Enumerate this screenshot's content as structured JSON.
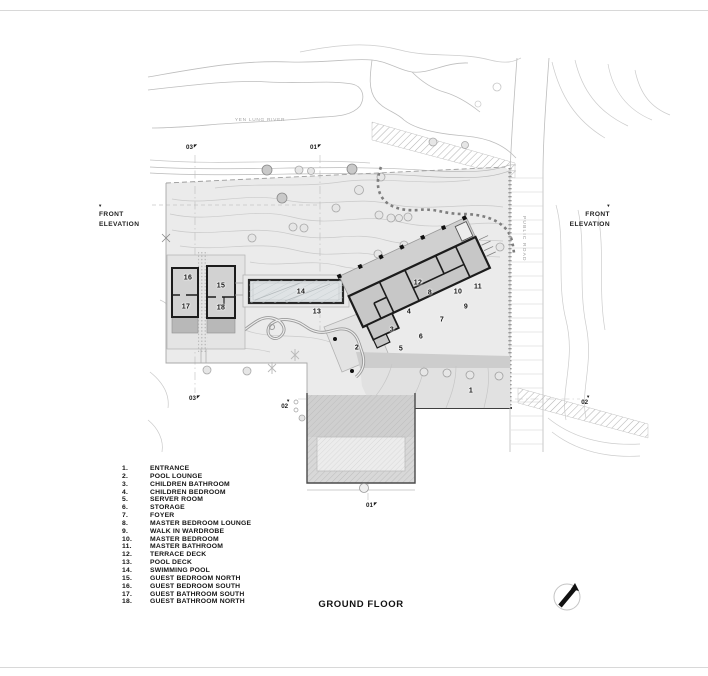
{
  "title": "GROUND FLOOR",
  "annotations": {
    "river_label": "YEN LUNG RIVER",
    "road_label": "PUBLIC ROAD",
    "elevation_left": "FRONT ELEVATION",
    "elevation_right": "FRONT ELEVATION"
  },
  "section_markers": [
    {
      "id": "03",
      "arrow": "nw",
      "x": 186,
      "y": 143
    },
    {
      "id": "01",
      "arrow": "nw",
      "x": 310,
      "y": 143
    },
    {
      "id": "03",
      "arrow": "nw",
      "x": 189,
      "y": 394
    },
    {
      "id": "02",
      "arrow": "down",
      "x": 280,
      "y": 398
    },
    {
      "id": "02",
      "arrow": "down",
      "x": 580,
      "y": 394
    },
    {
      "id": "01",
      "arrow": "nw",
      "x": 366,
      "y": 501
    }
  ],
  "plan_labels": [
    {
      "num": "1",
      "x": 471,
      "y": 391
    },
    {
      "num": "2",
      "x": 357,
      "y": 348
    },
    {
      "num": "3",
      "x": 392,
      "y": 330
    },
    {
      "num": "4",
      "x": 409,
      "y": 312
    },
    {
      "num": "5",
      "x": 401,
      "y": 349
    },
    {
      "num": "6",
      "x": 421,
      "y": 337
    },
    {
      "num": "7",
      "x": 442,
      "y": 320
    },
    {
      "num": "8",
      "x": 430,
      "y": 293
    },
    {
      "num": "9",
      "x": 466,
      "y": 307
    },
    {
      "num": "10",
      "x": 458,
      "y": 292
    },
    {
      "num": "11",
      "x": 478,
      "y": 287
    },
    {
      "num": "12",
      "x": 418,
      "y": 283
    },
    {
      "num": "13",
      "x": 317,
      "y": 312
    },
    {
      "num": "14",
      "x": 301,
      "y": 292
    },
    {
      "num": "15",
      "x": 221,
      "y": 286
    },
    {
      "num": "16",
      "x": 188,
      "y": 278
    },
    {
      "num": "17",
      "x": 186,
      "y": 307
    },
    {
      "num": "18",
      "x": 221,
      "y": 308
    }
  ],
  "legend": {
    "items": [
      {
        "num": "1.",
        "label": "ENTRANCE"
      },
      {
        "num": "2.",
        "label": "POOL LOUNGE"
      },
      {
        "num": "3.",
        "label": "CHILDREN BATHROOM"
      },
      {
        "num": "4.",
        "label": "CHILDREN BEDROOM"
      },
      {
        "num": "5.",
        "label": "SERVER ROOM"
      },
      {
        "num": "6.",
        "label": "STORAGE"
      },
      {
        "num": "7.",
        "label": "FOYER"
      },
      {
        "num": "8.",
        "label": "MASTER BEDROOM LOUNGE"
      },
      {
        "num": "9.",
        "label": "WALK IN WARDROBE"
      },
      {
        "num": "10.",
        "label": "MASTER BEDROOM"
      },
      {
        "num": "11.",
        "label": "MASTER BATHROOM"
      },
      {
        "num": "12.",
        "label": "TERRACE DECK"
      },
      {
        "num": "13.",
        "label": "POOL DECK"
      },
      {
        "num": "14.",
        "label": "SWIMMING POOL"
      },
      {
        "num": "15.",
        "label": "GUEST BEDROOM NORTH"
      },
      {
        "num": "16.",
        "label": "GUEST BEDROOM SOUTH"
      },
      {
        "num": "17.",
        "label": "GUEST BATHROOM SOUTH"
      },
      {
        "num": "18.",
        "label": "GUEST BATHROOM NORTH"
      }
    ]
  },
  "colors": {
    "site_fill": "#ebebeb",
    "building_fill": "#c7c7c7",
    "wall": "#1c1c1c",
    "contour": "#c9c9c9",
    "text": "#141414"
  }
}
